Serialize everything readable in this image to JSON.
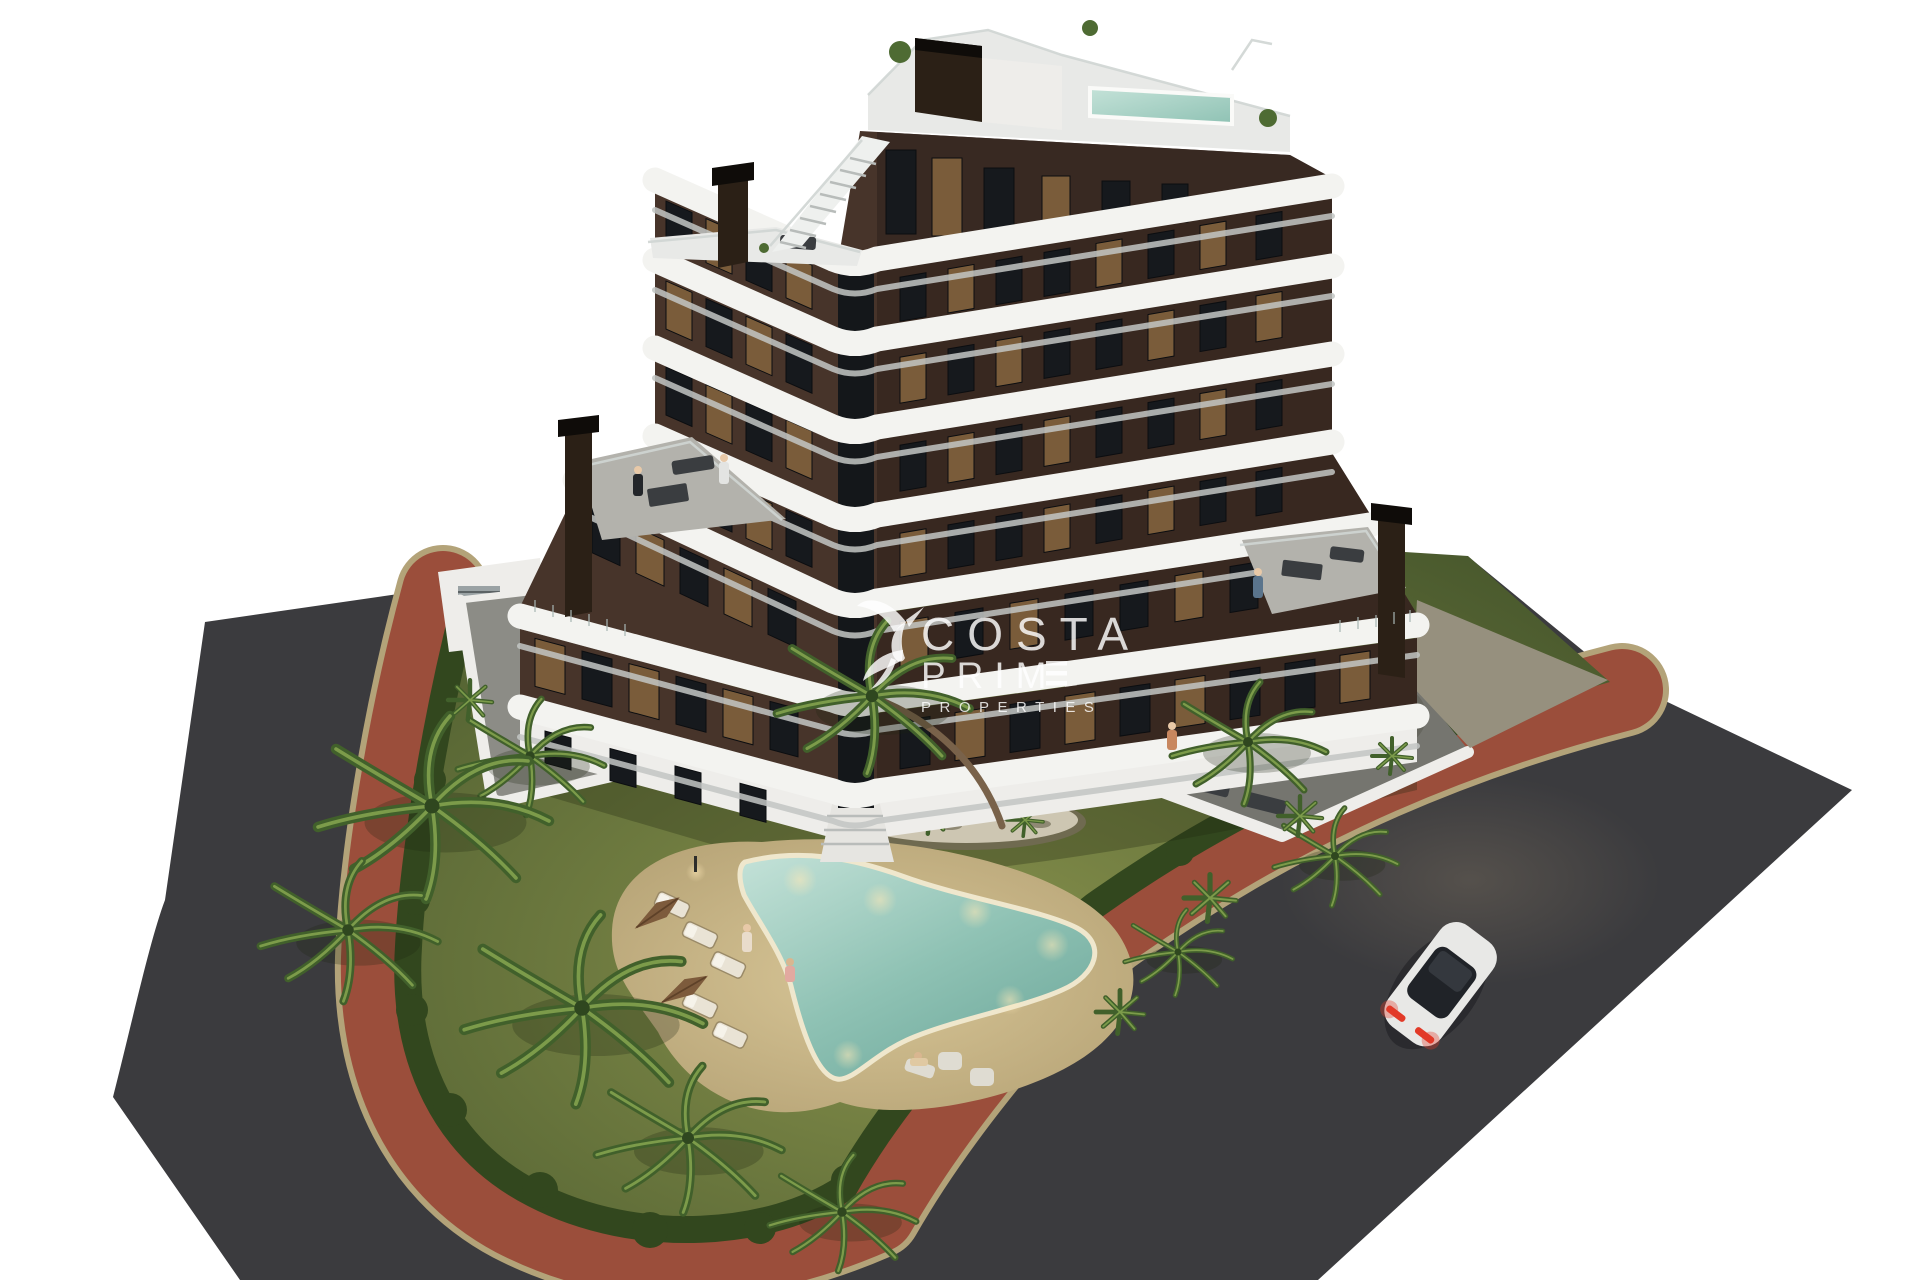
{
  "watermark": {
    "line_costa": "COSTA",
    "line_prime_partial": "PRIM",
    "line_properties": "PROPERTIES",
    "note": "logo of hummingbird at left of text, final E of PRIME drawn as three bars"
  },
  "scene": {
    "type": "3d-architectural-render-aerial",
    "building": {
      "style": "chevron-shaped apartment block, dark brown facade with white curved balcony bands",
      "visible_floor_bands": 7,
      "rooftop": [
        "roof terrace",
        "small rooftop pool",
        "white staircase",
        "dark feature wall",
        "chimneys"
      ],
      "ground": [
        "left walled terrace",
        "right walled terrace",
        "entrance steps"
      ]
    },
    "garden": [
      "lawn",
      "perimeter hedge",
      "palm trees",
      "yucca plants",
      "stone island bed"
    ],
    "pool_area": [
      "boomerang shaped pool",
      "sandy deck",
      "sun loungers",
      "closed umbrellas",
      "underwater lights",
      "lounge chairs"
    ],
    "roads": [
      "asphalt road wrapping left and bottom",
      "wide diagonal asphalt road at right",
      "red brick sidewalk ring with tan curbs"
    ],
    "vehicles": [
      "white sports car with red tail lights on right road"
    ],
    "people_count_hint": 8
  },
  "colors": {
    "bg": "#ffffff",
    "asphalt": "#3b3b3e",
    "brick": "#9b4e3b",
    "curb": "#b3a379",
    "grass-l": "#87914c",
    "grass-d": "#47572c",
    "hedge": "#32471e",
    "facade-l": "#47342a",
    "facade-r": "#342720",
    "glass": "#16191d",
    "glass-lit": "#7a5c3a",
    "band": "#f3f3f0",
    "band-shadow": "#c3c6c4",
    "white-wall": "#eeedea",
    "deck-gray": "#b3b2ac",
    "roof-deck": "#e8e9e7",
    "concrete": "#8c8c86",
    "concrete-dark": "#75756f",
    "sand": "#d8c697",
    "sand-d": "#b3a073",
    "pool-1": "#c4e2d8",
    "pool-2": "#8fc2b4",
    "pool-deep": "#6fa99c",
    "umbrella": "#7d5b3c",
    "palm-d": "#41602b",
    "palm-l": "#7c9b4a",
    "trunk": "#79624a",
    "stone": "#cdc6b2",
    "car-body": "#e8e8e6",
    "car-glass": "#202328",
    "tail": "#e23a28",
    "light-warm": "#ffe9b8"
  }
}
